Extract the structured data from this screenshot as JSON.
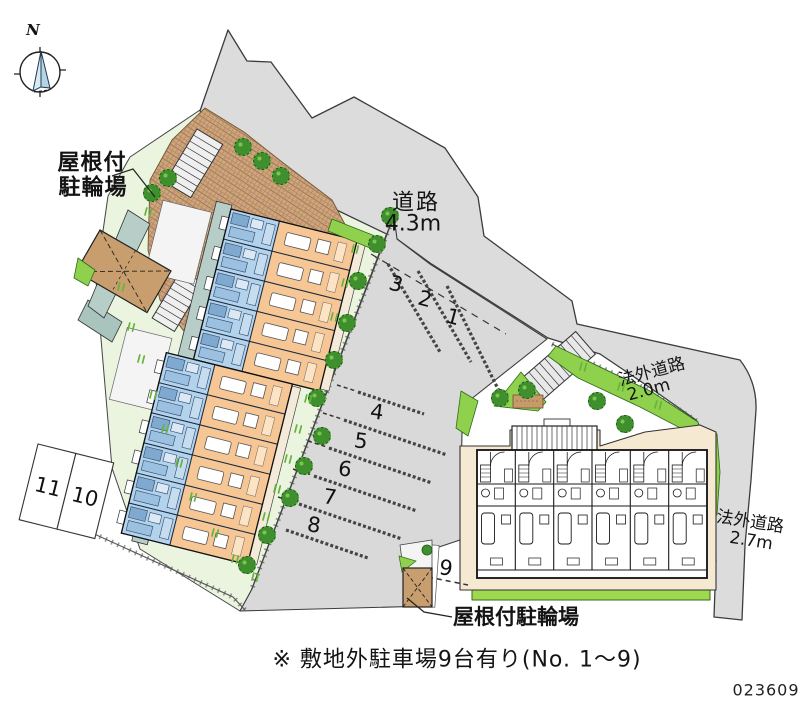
{
  "compass": {
    "north_label": "N"
  },
  "labels": {
    "bike_shelter_top_line1": "屋根付",
    "bike_shelter_top_line2": "駐輪場",
    "road_name": "道路",
    "road_width": "4.3m",
    "offsite_road_1_name": "法外道路",
    "offsite_road_1_width": "2.0m",
    "offsite_road_2_name": "法外道路",
    "offsite_road_2_width": "2.7m",
    "bike_shelter_bottom": "屋根付駐輪場",
    "note": "※ 敷地外駐車場9台有り(No. 1～9)",
    "plan_number": "023609"
  },
  "parking": {
    "spaces": [
      "1",
      "2",
      "3",
      "4",
      "5",
      "6",
      "7",
      "8",
      "9",
      "10",
      "11"
    ]
  },
  "colors": {
    "road_gray": "#dcdcdc",
    "site_green": "#eaf4de",
    "hedge_green": "#8fd14c",
    "tree_green": "#3f8f2f",
    "unit_blue": "#b3d3ec",
    "unit_orange": "#f6c795",
    "shed_brown": "#c99e6e",
    "base_cream": "#f6e9d2"
  }
}
